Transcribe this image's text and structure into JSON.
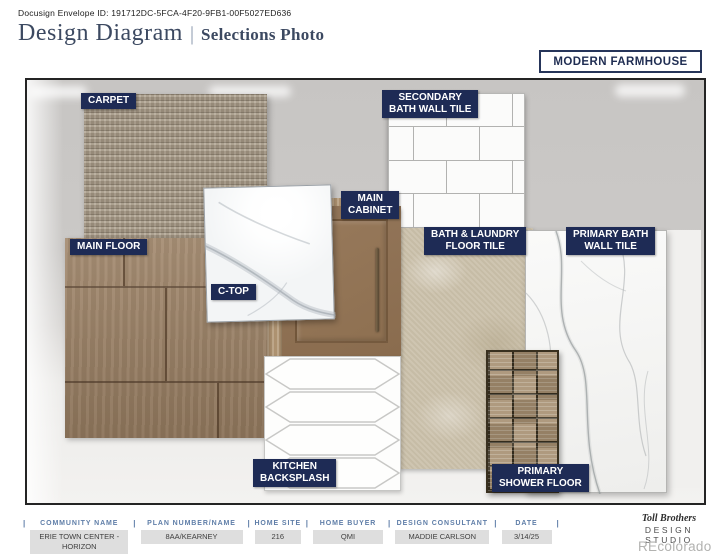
{
  "page": {
    "envelope_id": "Docusign Envelope ID: 191712DC-5FCA-4F20-9FB1-00F5027ED636",
    "title": "Design Diagram",
    "divider": "|",
    "subtitle": "Selections Photo",
    "style_name": "MODERN FARMHOUSE"
  },
  "labels": {
    "carpet": "CARPET",
    "main_floor": "MAIN FLOOR",
    "c_top": "C-TOP",
    "main_cabinet": [
      "MAIN",
      "CABINET"
    ],
    "secondary_bath_wall_tile": [
      "SECONDARY",
      "BATH WALL TILE"
    ],
    "bath_laundry_floor_tile": [
      "BATH & LAUNDRY",
      "FLOOR TILE"
    ],
    "primary_bath_wall_tile": [
      "PRIMARY BATH",
      "WALL TILE"
    ],
    "kitchen_backsplash": [
      "KITCHEN",
      "BACKSPLASH"
    ],
    "primary_shower_floor": [
      "PRIMARY",
      "SHOWER FLOOR"
    ]
  },
  "footer": {
    "separator": "|",
    "columns": [
      {
        "label": "COMMUNITY NAME",
        "value": "ERIE TOWN CENTER - HORIZON"
      },
      {
        "label": "PLAN NUMBER/NAME",
        "value": "8AA/KEARNEY"
      },
      {
        "label": "HOME SITE",
        "value": "216"
      },
      {
        "label": "HOME BUYER",
        "value": "QMI"
      },
      {
        "label": "DESIGN CONSULTANT",
        "value": "MADDIE CARLSON"
      },
      {
        "label": "DATE",
        "value": "3/14/25"
      }
    ],
    "brand": {
      "name": "Toll Brothers",
      "studio": "DESIGN STUDIO",
      "watermark": "REcolorado"
    }
  },
  "colors": {
    "label_chip_bg": "#1e2b55",
    "accent_navy": "#1f2d52",
    "footer_header_blue": "#5f7ea8"
  }
}
